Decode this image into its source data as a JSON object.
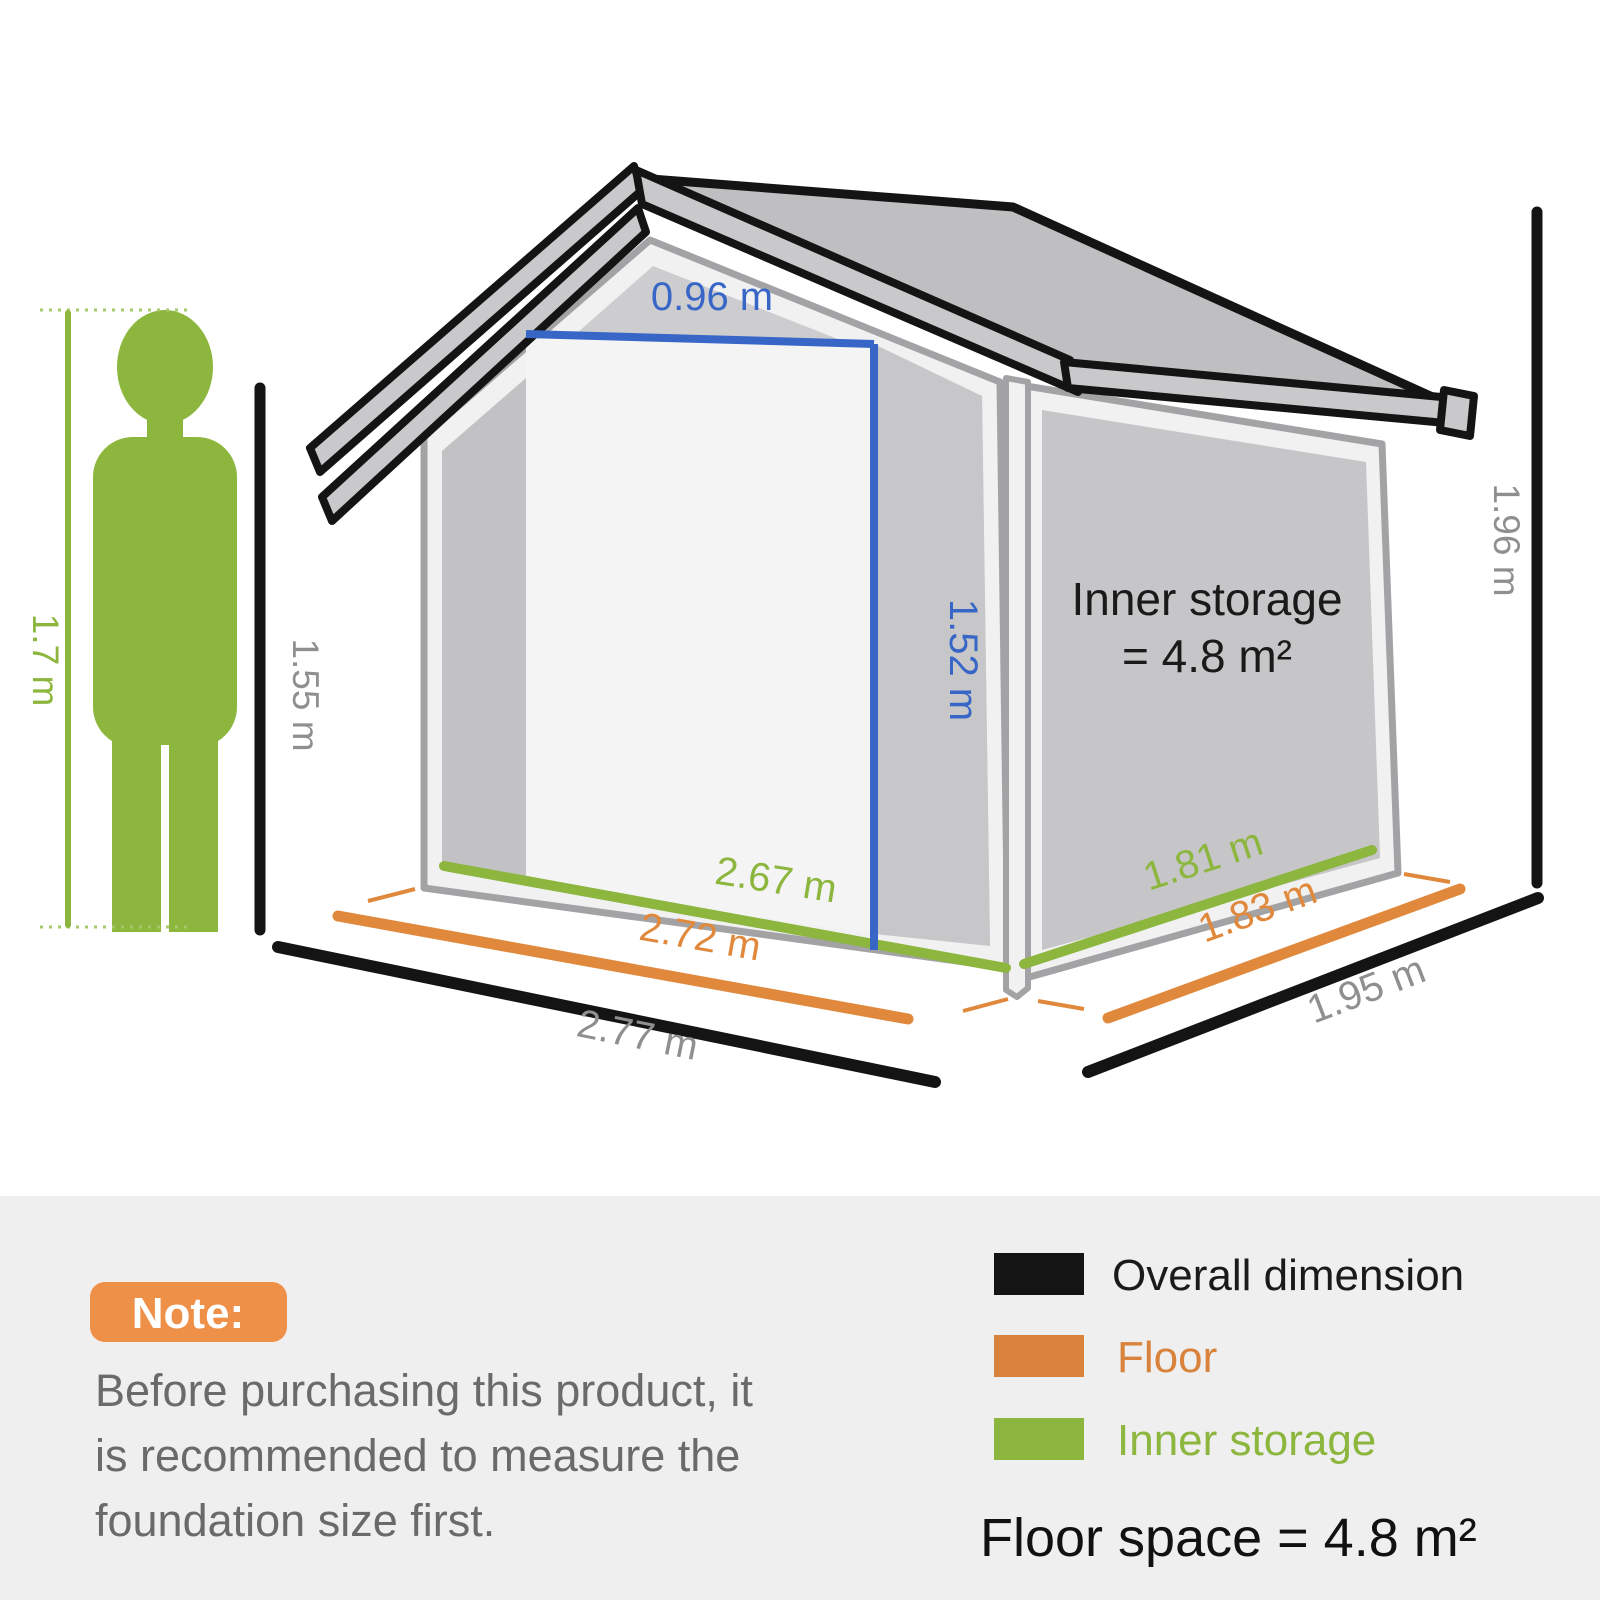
{
  "diagram_type": "garden-shed-dimension-diagram",
  "person": {
    "height_label": "1.7 m"
  },
  "dimensions": {
    "front_wall_height": "1.55 m",
    "overall_height": "1.96 m",
    "door_width": "0.96 m",
    "door_height": "1.52 m",
    "inner_width": "2.67 m",
    "floor_width": "2.72 m",
    "overall_width": "2.77 m",
    "inner_depth": "1.81 m",
    "floor_depth": "1.83 m",
    "overall_depth": "1.95 m"
  },
  "shed": {
    "inner_storage_line1": "Inner storage",
    "inner_storage_line2": "= 4.8 m²"
  },
  "note": {
    "badge": "Note:",
    "line1": "Before purchasing this product, it",
    "line2": "is recommended to measure the",
    "line3": "foundation size first."
  },
  "legend": {
    "items": [
      {
        "label": "Overall dimension",
        "color": "#141414",
        "text_color": "#1a1a1a"
      },
      {
        "label": "Floor",
        "color": "#d8823c",
        "text_color": "#d8823c"
      },
      {
        "label": "Inner storage",
        "color": "#8cb63e",
        "text_color": "#8cb63e"
      }
    ],
    "floor_space": "Floor space = 4.8 m²"
  },
  "colors": {
    "green": "#8cb63e",
    "orange": "#e0893c",
    "badge_orange": "#ef9049",
    "blue": "#3766c7",
    "gray_text": "#8f8f8f",
    "note_text": "#6a6a6a",
    "black": "#141414",
    "panel_bg": "#efefef"
  }
}
